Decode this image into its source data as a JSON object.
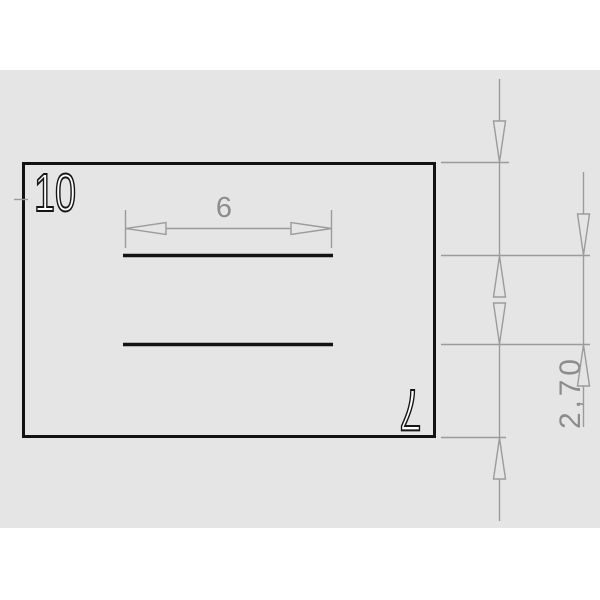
{
  "drawing": {
    "part": {
      "width_label": "10",
      "height_label": "7"
    },
    "dimensions": {
      "slot_length": "6",
      "top_spacing": "2,70",
      "middle_spacing": "2,60",
      "bottom_spacing": "2,70"
    }
  },
  "colors": {
    "background": "#ffffff",
    "sheet": "#e5e5e5",
    "part-line": "#121212",
    "dim-line": "#9b9b9b",
    "dim-text": "#8c8c8c",
    "label-fill": "#ffffff",
    "label-stroke": "#161616"
  }
}
